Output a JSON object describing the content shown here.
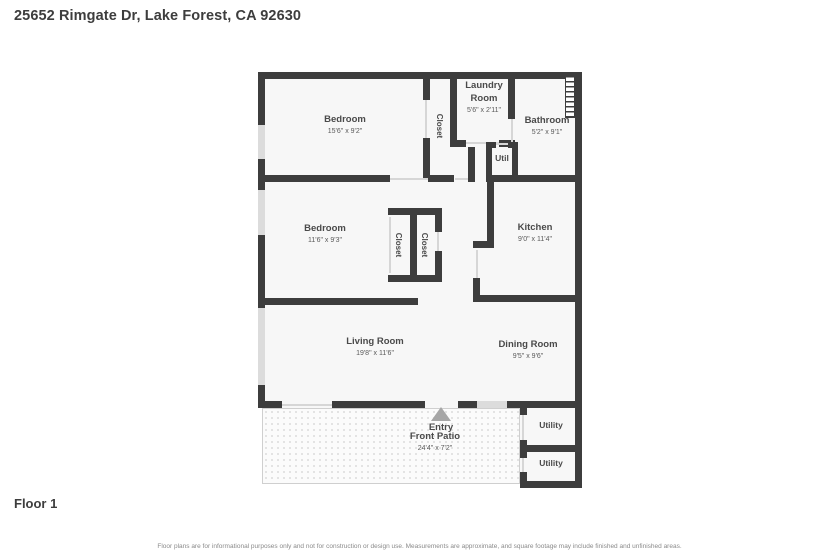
{
  "page": {
    "title": "25652 Rimgate Dr, Lake Forest, CA 92630",
    "floor_label": "Floor 1",
    "disclaimer": "Floor plans are for informational purposes only and not for construction or design use. Measurements are approximate, and square footage may include finished and unfinished areas."
  },
  "colors": {
    "wall": "#3d3d3d",
    "floor": "#f7f7f7",
    "window": "#dcdcdc",
    "label": "#4a4a4a"
  },
  "rooms": [
    {
      "id": "bedroom-1",
      "name": "Bedroom",
      "dims": "15'6\" x 9'2\""
    },
    {
      "id": "laundry",
      "name": "Laundry Room",
      "dims": "5'6\" x 2'11\""
    },
    {
      "id": "bathroom",
      "name": "Bathroom",
      "dims": "5'2\" x 9'1\""
    },
    {
      "id": "closet-top",
      "name": "Closet",
      "dims": ""
    },
    {
      "id": "util",
      "name": "Util",
      "dims": ""
    },
    {
      "id": "bedroom-2",
      "name": "Bedroom",
      "dims": "11'6\" x 9'3\""
    },
    {
      "id": "closet-left",
      "name": "Closet",
      "dims": ""
    },
    {
      "id": "closet-right",
      "name": "Closet",
      "dims": ""
    },
    {
      "id": "kitchen",
      "name": "Kitchen",
      "dims": "9'0\" x 11'4\""
    },
    {
      "id": "living-room",
      "name": "Living Room",
      "dims": "19'8\" x 11'6\""
    },
    {
      "id": "dining-room",
      "name": "Dining Room",
      "dims": "9'5\" x 9'6\""
    },
    {
      "id": "front-patio",
      "name": "Front Patio",
      "dims": "24'4\" x 7'2\""
    },
    {
      "id": "entry",
      "name": "Entry",
      "dims": ""
    },
    {
      "id": "utility-1",
      "name": "Utility",
      "dims": ""
    },
    {
      "id": "utility-2",
      "name": "Utility",
      "dims": ""
    }
  ]
}
